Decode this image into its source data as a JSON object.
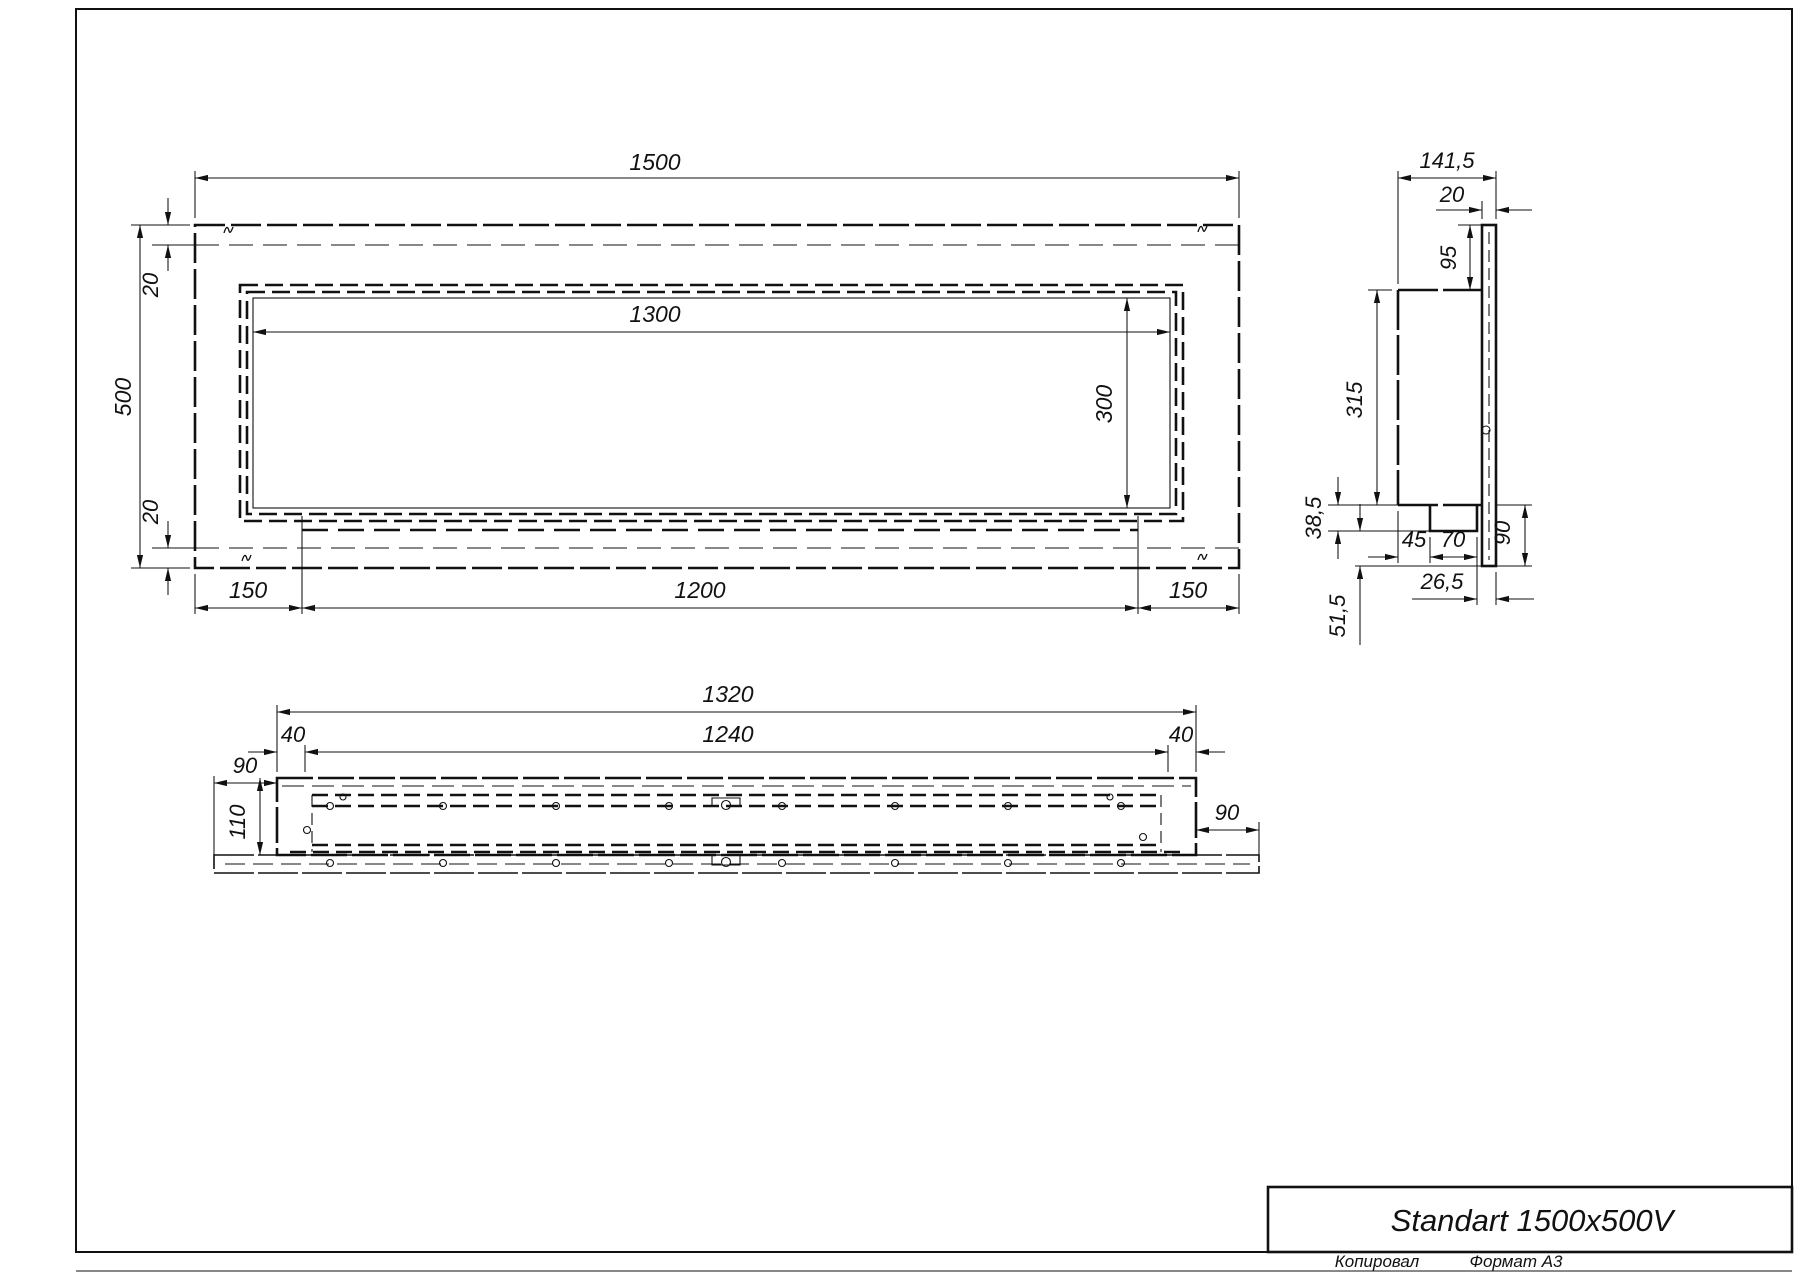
{
  "title_block": {
    "title": "Standart 1500x500V",
    "copied_label": "Копировал",
    "format_label": "Формат А3"
  },
  "views": {
    "front": {
      "overall_width": "1500",
      "overall_height": "500",
      "face_top": "20",
      "face_bottom": "20",
      "opening_width": "1300",
      "opening_height": "300",
      "margin_left": "150",
      "burner_length": "1200",
      "margin_right": "150"
    },
    "side": {
      "overall_depth": "141,5",
      "face_thickness": "20",
      "top_inset": "95",
      "body_height": "315",
      "tray_drop": "38,5",
      "tray_inset": "45",
      "tray_width": "70",
      "flange_drop": "90",
      "lip_offset": "26,5",
      "bottom_drop": "51,5"
    },
    "bottom": {
      "body_length": "1320",
      "tray_length": "1240",
      "inset_left": "40",
      "inset_right": "40",
      "overhang_left": "90",
      "overhang_right": "90",
      "body_depth": "110"
    }
  }
}
